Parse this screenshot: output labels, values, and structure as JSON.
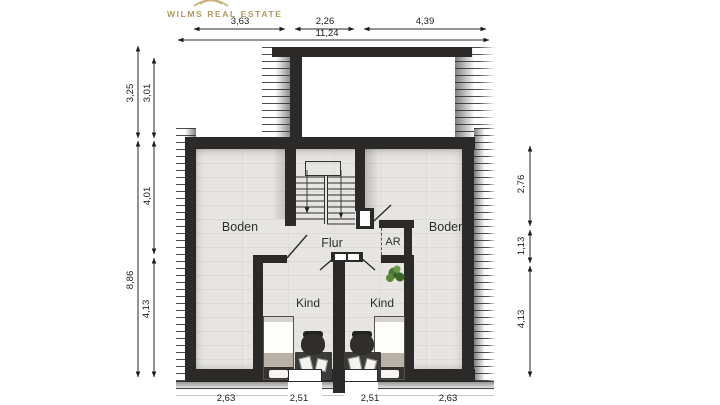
{
  "brand": {
    "name": "WILMS REAL ESTATE"
  },
  "labels": {
    "boden_left": "Boden",
    "boden_right": "Boden",
    "flur": "Flur",
    "ar": "AR",
    "kind_left": "Kind",
    "kind_right": "Kind"
  },
  "dims": {
    "top": [
      "3,63",
      "2,26",
      "4,39"
    ],
    "top_total": "11,24",
    "left_outer": [
      "3,25",
      "8,86"
    ],
    "left_inner": [
      "3,01",
      "4,01",
      "4,13"
    ],
    "right": [
      "2,76",
      "1,13",
      "4,13"
    ],
    "bottom": [
      "2,63",
      "2,51",
      "2,51",
      "2,63"
    ]
  },
  "colors": {
    "wall": "#2b2a28",
    "floor": "#e7e5e2",
    "brand_gold": "#b2995e",
    "plant_green": "#4c7a31"
  }
}
